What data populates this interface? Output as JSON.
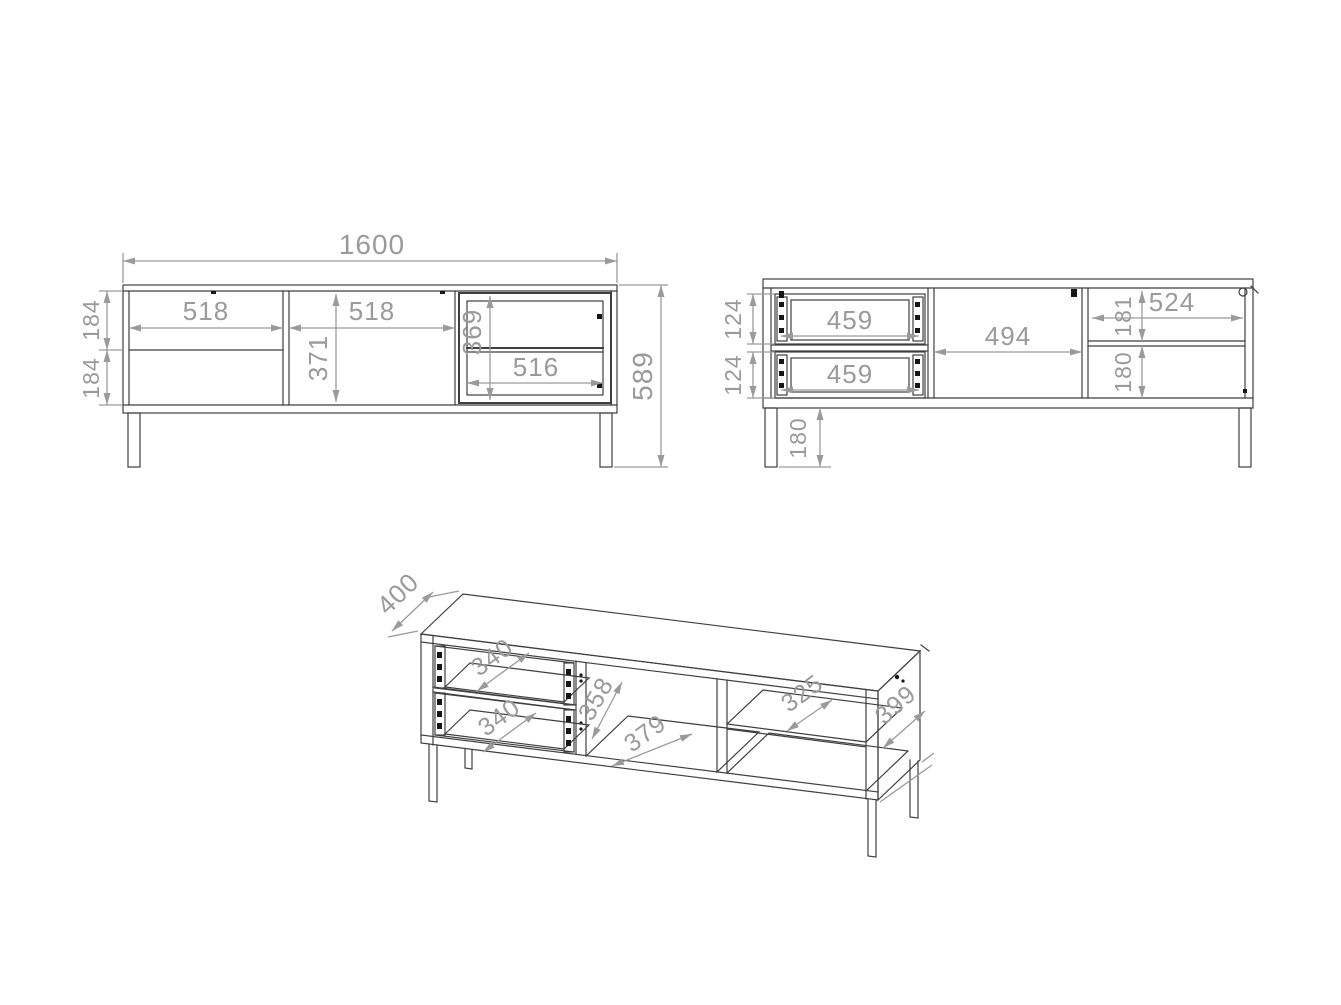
{
  "front_view": {
    "total_width": "1600",
    "total_height": "589",
    "left_section_width": "518",
    "middle_section_width": "518",
    "middle_door_height": "371",
    "glass_section_height": "369",
    "glass_section_width": "516",
    "left_top_front_height": "184",
    "left_bottom_front_height": "184"
  },
  "back_view": {
    "top_drawer_width": "459",
    "bottom_drawer_width": "459",
    "top_drawer_height": "124",
    "bottom_drawer_height": "124",
    "middle_compartment_width": "494",
    "right_compartment_width": "524",
    "right_top_compartment_height": "181",
    "right_bottom_compartment_height": "180",
    "leg_height": "180"
  },
  "iso_view": {
    "depth": "400",
    "top_drawer_inner_width": "340",
    "bottom_drawer_inner_width": "340",
    "middle_compartment_height": "358",
    "middle_compartment_width": "379",
    "right_shelf_depth": "325",
    "side_depth": "399"
  },
  "colors": {
    "line": "#3f3f3f",
    "dim": "#9a9a9a",
    "accent_black": "#161616",
    "background": "#ffffff"
  }
}
